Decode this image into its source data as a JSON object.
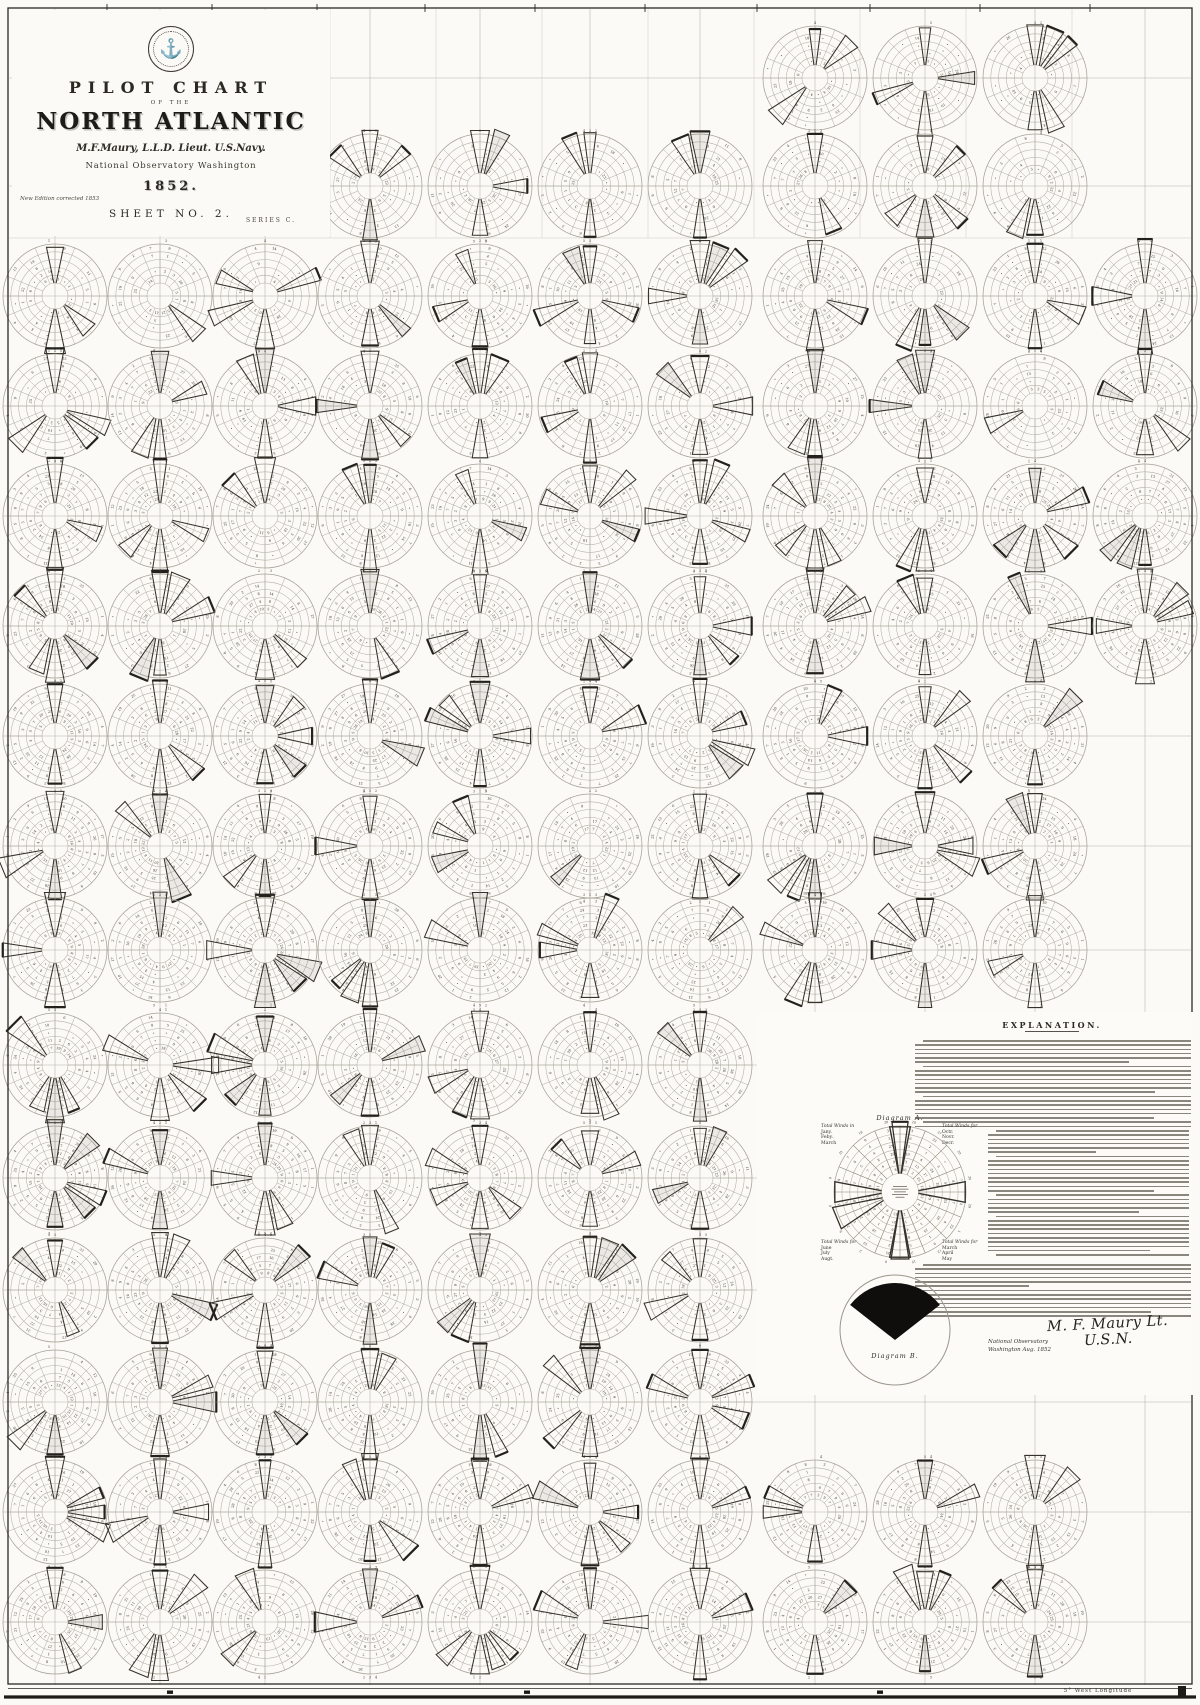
{
  "title_block": {
    "seal": "navy-eagle-anchor-seal",
    "line1": "PILOT CHART",
    "line2": "OF THE",
    "line3": "NORTH ATLANTIC",
    "author": "M.F.Maury, L.L.D. Lieut. U.S.Navy.",
    "observatory": "National Observatory Washington",
    "year": "1852.",
    "edition_note": "New Edition corrected 1853",
    "sheet": "SHEET NO. 2.",
    "series": "SERIES C."
  },
  "explanation": {
    "heading": "EXPLANATION.",
    "body_note": "dense fine-print paragraphs (illegible at scan resolution)",
    "blocks": [
      {
        "lines": 21
      },
      {
        "lines": 30
      },
      {
        "lines": 13
      }
    ]
  },
  "diagram_a": {
    "label": "Diagram A.",
    "corners": [
      {
        "title": "Total Winds in",
        "lines": [
          "Jany.",
          "Feby.",
          "March"
        ]
      },
      {
        "title": "Total Winds for",
        "lines": [
          "Octr.",
          "Novr.",
          "Decr."
        ]
      },
      {
        "title": "Total Winds for",
        "lines": [
          "June",
          "July",
          "Augt."
        ]
      },
      {
        "title": "Total Winds for",
        "lines": [
          "March",
          "April",
          "May"
        ]
      }
    ]
  },
  "diagram_b": {
    "label": "Diagram B."
  },
  "signature": {
    "name_script": "M. F. Maury Lt. U.S.N.",
    "office_line1": "National Observatory",
    "office_line2": "Washington Aug. 1852"
  },
  "border": {
    "bottom_right_label": "5° West Longitude"
  },
  "chart_data": {
    "type": "wind-rose-grid",
    "title": "Pilot Chart of the North Atlantic, Sheet No. 2 (Maury, 1852)",
    "description": "Lattice of monthly wind-rose diagrams at 5-degree squares; 16 compass sectors, 5 concentric rings per rose; individual cell counts illegible at scan resolution and simulated procedurally.",
    "grid": {
      "col_centers_x": [
        55,
        160,
        265,
        370,
        480,
        590,
        700,
        815,
        925,
        1035,
        1145
      ],
      "row_centers_y": [
        78,
        186,
        296,
        406,
        516,
        626,
        736,
        846,
        950,
        1065,
        1178,
        1290,
        1402,
        1512,
        1622
      ],
      "rose_radius": 52,
      "sectors": 16,
      "rings": 5,
      "rows_with_roses": [
        [
          7,
          8,
          9
        ],
        [
          3,
          4,
          5,
          6,
          7,
          8,
          9
        ],
        [
          0,
          1,
          2,
          3,
          4,
          5,
          6,
          7,
          8,
          9,
          10
        ],
        [
          0,
          1,
          2,
          3,
          4,
          5,
          6,
          7,
          8,
          9,
          10
        ],
        [
          0,
          1,
          2,
          3,
          4,
          5,
          6,
          7,
          8,
          9,
          10
        ],
        [
          0,
          1,
          2,
          3,
          4,
          5,
          6,
          7,
          8,
          9,
          10
        ],
        [
          0,
          1,
          2,
          3,
          4,
          5,
          6,
          7,
          8,
          9
        ],
        [
          0,
          1,
          2,
          3,
          4,
          5,
          6,
          7,
          8,
          9
        ],
        [
          0,
          1,
          2,
          3,
          4,
          5,
          6,
          7,
          8,
          9
        ],
        [
          0,
          1,
          2,
          3,
          4,
          5,
          6
        ],
        [
          0,
          1,
          2,
          3,
          4,
          5,
          6
        ],
        [
          0,
          1,
          2,
          3,
          4,
          5,
          6
        ],
        [
          0,
          1,
          2,
          3,
          4,
          5,
          6
        ],
        [
          0,
          1,
          2,
          3,
          4,
          5,
          6,
          7,
          8,
          9
        ],
        [
          0,
          1,
          2,
          3,
          4,
          5,
          6,
          7,
          8,
          9
        ]
      ]
    },
    "seed": 11,
    "diagram_a": {
      "cx": 900,
      "cy": 1192,
      "r": 66,
      "sectors": 16,
      "rings": 6
    },
    "diagram_b": {
      "cx": 895,
      "cy": 1330,
      "r": 55,
      "black_fan_half_angle_deg": 52
    },
    "colors": {
      "paper": "#fbfaf6",
      "ink": "#2e2c27",
      "faint_ring": "#b3afa5",
      "grid_line": "#b6b2a8",
      "wedge": "#35322b",
      "number": "#3a372f"
    }
  }
}
